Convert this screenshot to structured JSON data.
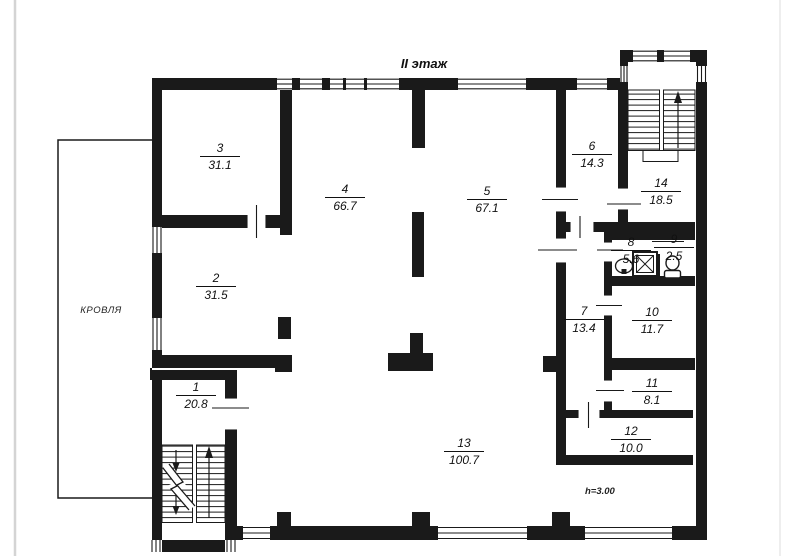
{
  "title": "II этаж",
  "roof_label": "КРОВЛЯ",
  "height_note": "h=3.00",
  "colors": {
    "ink": "#1a1a1a",
    "page_edge": "#d4d4d4"
  },
  "rooms": [
    {
      "number": "1",
      "area": "20.8"
    },
    {
      "number": "2",
      "area": "31.5"
    },
    {
      "number": "3",
      "area": "31.1"
    },
    {
      "number": "4",
      "area": "66.7"
    },
    {
      "number": "5",
      "area": "67.1"
    },
    {
      "number": "6",
      "area": "14.3"
    },
    {
      "number": "7",
      "area": "13.4"
    },
    {
      "number": "8",
      "area": "5.6"
    },
    {
      "number": "9",
      "area": "2.5"
    },
    {
      "number": "10",
      "area": "11.7"
    },
    {
      "number": "11",
      "area": "8.1"
    },
    {
      "number": "12",
      "area": "10.0"
    },
    {
      "number": "13",
      "area": "100.7"
    },
    {
      "number": "14",
      "area": "18.5"
    }
  ]
}
